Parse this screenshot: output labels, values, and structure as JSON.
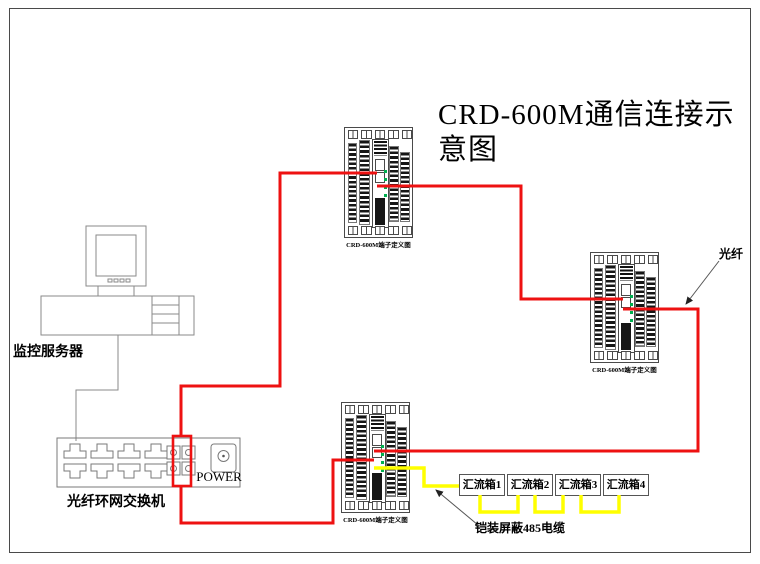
{
  "title": "CRD-600M通信连接示意图",
  "server": {
    "label": "监控服务器"
  },
  "switch": {
    "label": "光纤环网交换机",
    "power_label": "POWER"
  },
  "devices": [
    {
      "caption": "CRD-600M端子定义图"
    },
    {
      "caption": "CRD-600M端子定义图"
    },
    {
      "caption": "CRD-600M端子定义图"
    }
  ],
  "combiner_boxes": [
    {
      "label": "汇流箱1"
    },
    {
      "label": "汇流箱2"
    },
    {
      "label": "汇流箱3"
    },
    {
      "label": "汇流箱4"
    }
  ],
  "annotations": {
    "fiber": "光纤",
    "cable485": "铠装屏蔽485电缆"
  },
  "colors": {
    "fiber_wire": "#ee1111",
    "cable485_wire": "#ffff00",
    "led_green": "#00b050"
  }
}
